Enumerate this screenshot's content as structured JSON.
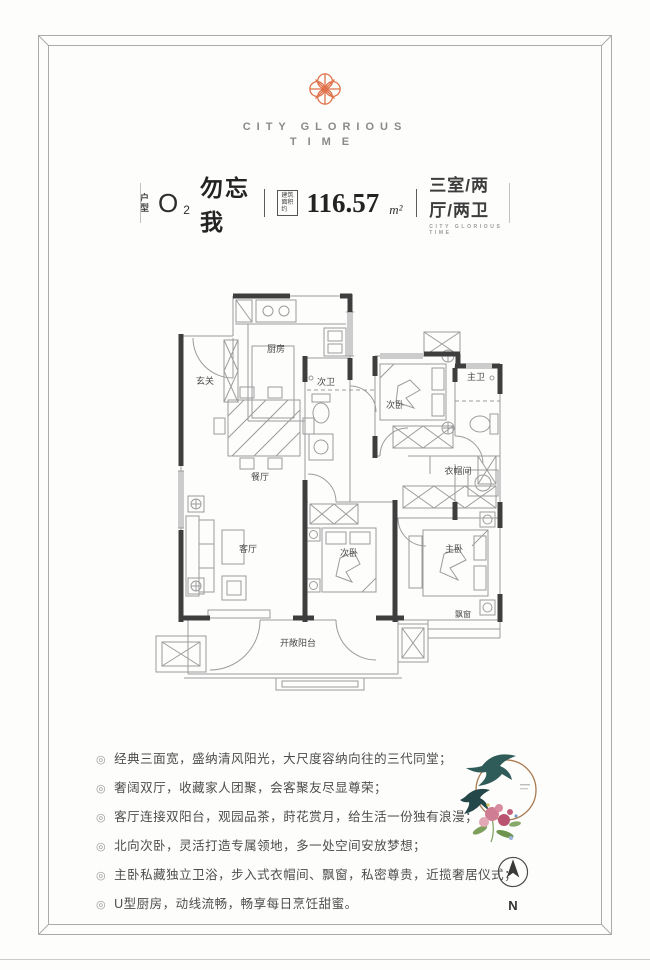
{
  "logo": {
    "brand_line1": "CITY GLORIOUS",
    "brand_line2": "TIME",
    "accent_color": "#e0714b"
  },
  "title_bar": {
    "type_label": "户型",
    "type_code": "O",
    "type_code_sub": "2",
    "type_name": "勿忘我",
    "area_box_line1": "建筑",
    "area_box_line2": "面积约",
    "area_value": "116.57",
    "area_unit": "m²",
    "layout": "三室/两厅/两卫",
    "layout_sub": "CITY GLORIOUS TIME"
  },
  "plan": {
    "labels": {
      "entry": "玄关",
      "kitchen": "厨房",
      "dining": "餐厅",
      "bath_second": "次卫",
      "bedroom_north": "次卧",
      "bath_master": "主卫",
      "closet": "衣帽间",
      "living": "客厅",
      "bedroom_south": "次卧",
      "master": "主卧",
      "bay_window": "飘窗",
      "balcony": "开敞阳台"
    },
    "wall_color": "#3e3e3e",
    "line_color": "#9c9c9c"
  },
  "features": {
    "bullet": "◎",
    "items": [
      "经典三面宽，盛纳清风阳光，大尺度容纳向往的三代同堂；",
      "奢阔双厅，收藏家人团聚，会客聚友尽显尊荣；",
      "客厅连接双阳台，观园品茶，莳花赏月，给生活一份独有浪漫；",
      "北向次卧，灵活打造专属领地，多一处空间安放梦想；",
      "主卧私藏独立卫浴，步入式衣帽间、飘窗，私密尊贵，近揽奢居仪式；",
      "U型厨房，动线流畅，畅享每日烹饪甜蜜。"
    ]
  },
  "compass": {
    "label": "N"
  }
}
